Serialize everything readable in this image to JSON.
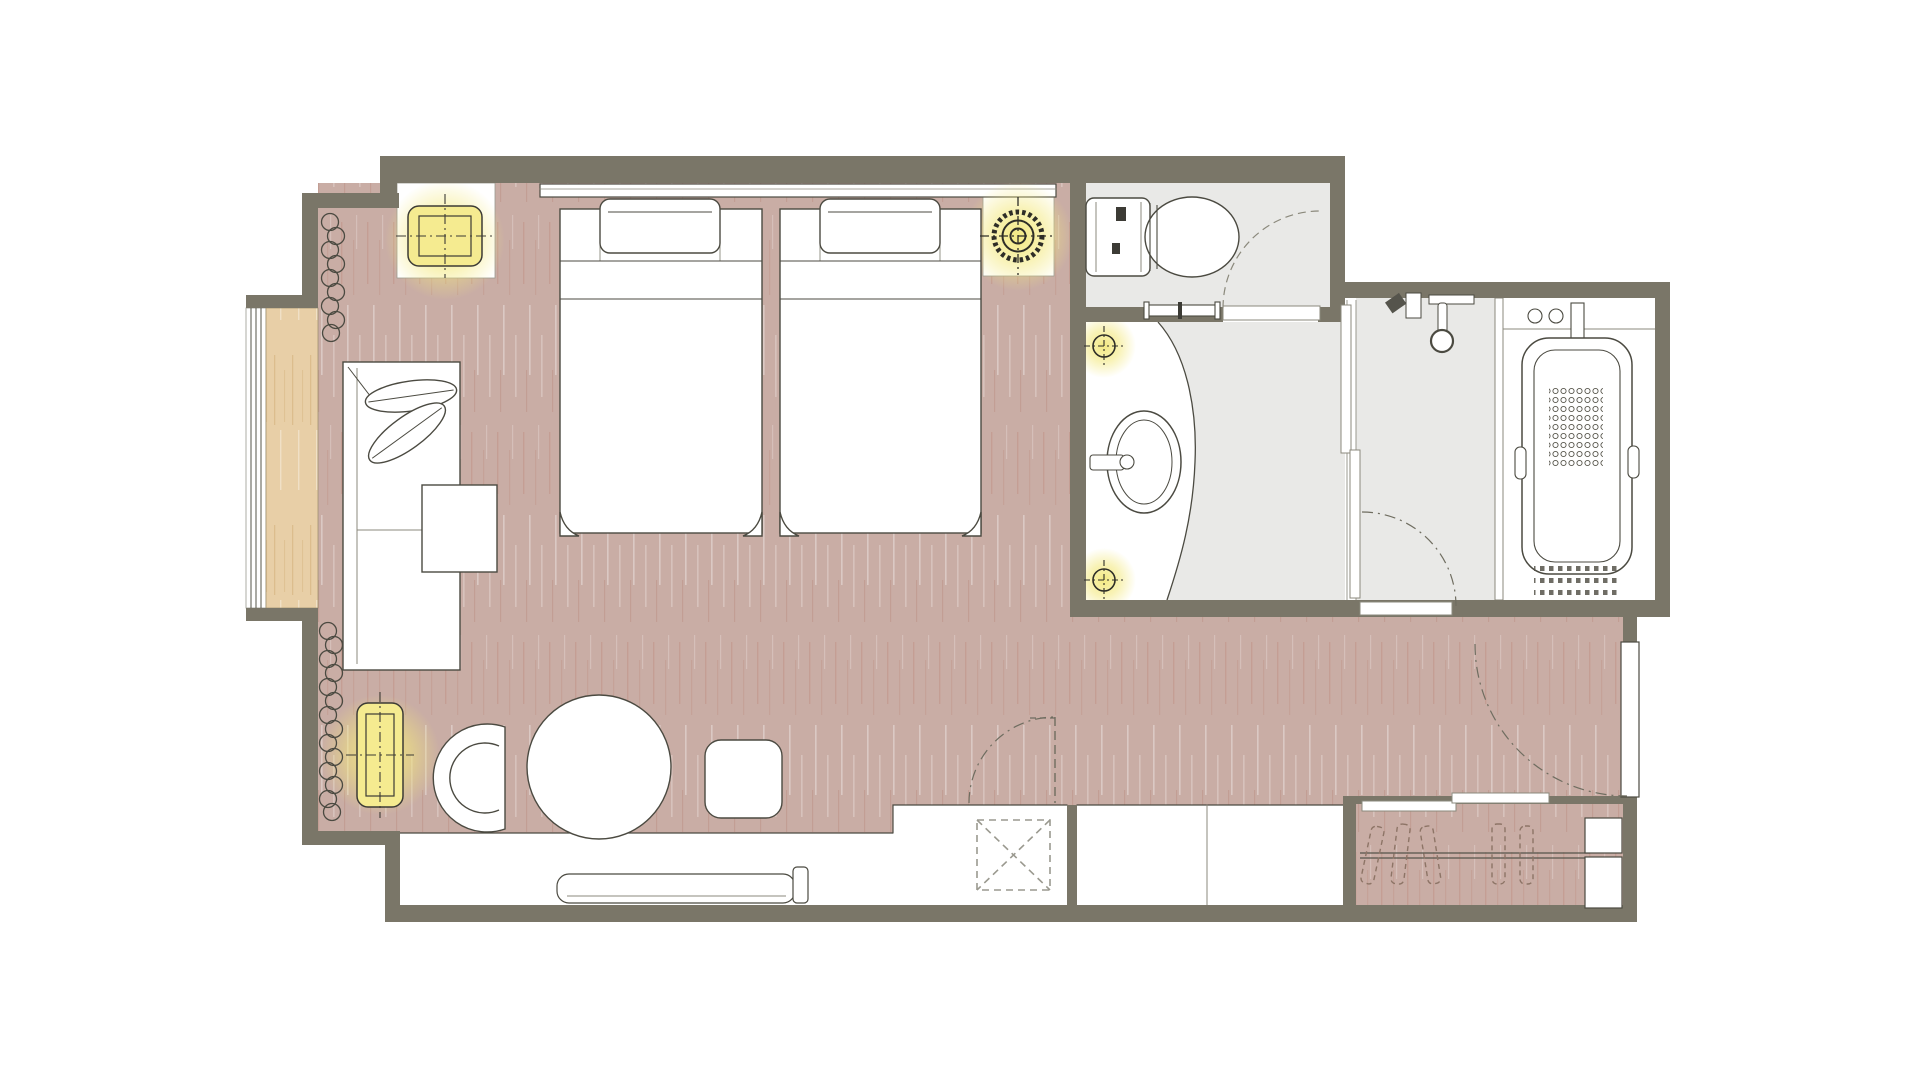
{
  "page": {
    "type": "architectural-floor-plan",
    "subject": "hotel guest room with twin beds, bathroom, shower room, toilet room and entry closet",
    "visible_text": []
  },
  "colors": {
    "background": "#ffffff",
    "wall": "#7a7668",
    "floor_wood": "#c9ada5",
    "floor_streak_dark": "#b06a58",
    "floor_streak_light": "#ffffff",
    "sill_wood": "#e8cfa7",
    "sill_streak": "#c49a5c",
    "bath_floor": "#e9e9e7",
    "fixture_white": "#ffffff",
    "outline": "#4b4a41",
    "soft_line": "#8b897c",
    "dash_line": "#6f6d60",
    "lamp_glow": "#f3e87c",
    "lamp_fill": "#f5eb90",
    "symbol_ink": "#2e2d27"
  },
  "rooms": [
    {
      "id": "bedroom",
      "kind": "twin bedroom with wood floor"
    },
    {
      "id": "window-bay",
      "kind": "full-height window with wooden sill"
    },
    {
      "id": "toilet-room",
      "kind": "toilet room with swing door"
    },
    {
      "id": "vanity-room",
      "kind": "washbasin room with curved counter"
    },
    {
      "id": "shower-room",
      "kind": "shower room with sliding partition"
    },
    {
      "id": "bathtub-room",
      "kind": "bathtub room with deck faucet"
    },
    {
      "id": "entry-corridor",
      "kind": "entrance corridor"
    },
    {
      "id": "closet",
      "kind": "sliding-door wardrobe with hanger rod and shoe cabinet"
    }
  ],
  "furniture": [
    {
      "id": "headboard",
      "count": 1
    },
    {
      "id": "twin-bed",
      "count": 2
    },
    {
      "id": "pillow",
      "count": 2
    },
    {
      "id": "nightstand",
      "count": 2
    },
    {
      "id": "sofa-with-cushions",
      "count": 1
    },
    {
      "id": "side-table",
      "count": 1
    },
    {
      "id": "lounge-chair",
      "count": 1
    },
    {
      "id": "round-table",
      "count": 1
    },
    {
      "id": "stool",
      "count": 1
    },
    {
      "id": "luggage-bench-tray",
      "count": 1
    },
    {
      "id": "counter-cabinets",
      "count": 3
    },
    {
      "id": "luggage-rack-dashed-x",
      "count": 1
    },
    {
      "id": "shoe-cabinet",
      "count": 1
    }
  ],
  "fixtures": [
    {
      "id": "toilet",
      "count": 1
    },
    {
      "id": "towel-bar",
      "count": 1
    },
    {
      "id": "washbasin-oval",
      "count": 1
    },
    {
      "id": "wall-faucet",
      "count": 1
    },
    {
      "id": "shower-head",
      "count": 1
    },
    {
      "id": "bathtub-with-antislip-dots",
      "count": 1
    }
  ],
  "lighting": [
    {
      "id": "table-lamp-glowing",
      "count": 1
    },
    {
      "id": "floor-lamp-glowing",
      "count": 1
    },
    {
      "id": "ceiling-light-symbol-large",
      "count": 1
    },
    {
      "id": "downlight-symbol-small",
      "count": 2
    }
  ],
  "doors": [
    {
      "id": "entrance-door",
      "type": "swing",
      "arc": "dash-dot"
    },
    {
      "id": "toilet-door",
      "type": "swing",
      "arc": "dashed"
    },
    {
      "id": "shower-door",
      "type": "swing",
      "arc": "dash-dot"
    },
    {
      "id": "privacy-door",
      "type": "swing-open-position",
      "arc": "dash-dot"
    },
    {
      "id": "closet-sliding-door",
      "type": "sliding",
      "leaves": 2
    },
    {
      "id": "vanity-shower-sliding-door",
      "type": "sliding",
      "leaves": 2
    }
  ],
  "symbols": [
    {
      "id": "curtain-coil-symbol",
      "count": 2
    }
  ]
}
